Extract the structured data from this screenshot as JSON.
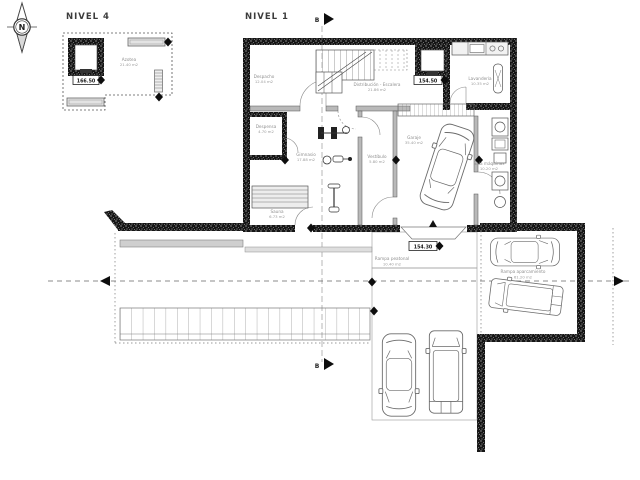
{
  "compass": {
    "letter": "N"
  },
  "section": {
    "label": "B"
  },
  "plans": {
    "nivel4": {
      "title": "NIVEL 4",
      "level_marker": "166.50",
      "rooms": {
        "azotea": {
          "name": "Azotea",
          "area": "21.40 m2"
        }
      }
    },
    "nivel1": {
      "title": "NIVEL 1",
      "level_marker_upper": "154.50",
      "level_marker_lower": "154.30",
      "rooms": {
        "despacho": {
          "name": "Despacho",
          "area": "12.04 m2"
        },
        "distribucion": {
          "name": "Distribución - Escalera",
          "area": "21.86 m2"
        },
        "lavanderia": {
          "name": "Lavandería",
          "area": "10.35 m2"
        },
        "despensa": {
          "name": "Despensa",
          "area": "4.70 m2"
        },
        "gimnasio": {
          "name": "Gimnasio",
          "area": "17.88 m2"
        },
        "sauna": {
          "name": "Sauna",
          "area": "6.73 m2"
        },
        "vestibulo": {
          "name": "Vestíbulo",
          "area": "5.80 m2"
        },
        "garaje": {
          "name": "Garaje",
          "area": "35.40 m2"
        },
        "sala_maquinas": {
          "name": "Sala máquinas",
          "area": "10.20 m2"
        },
        "rampa_peatonal": {
          "name": "Rampa peatonal",
          "area": "10.40 m2"
        },
        "rampa_aparcamiento": {
          "name": "Rampa aparcamiento",
          "area": "61.20 m2"
        }
      }
    }
  },
  "colors": {
    "background": "#ffffff",
    "wall": "#161616",
    "line_dark": "#444444",
    "line_gray": "#8c8c8c",
    "label_text": "#8f8f8f",
    "fill_light": "#e3e3e3"
  }
}
